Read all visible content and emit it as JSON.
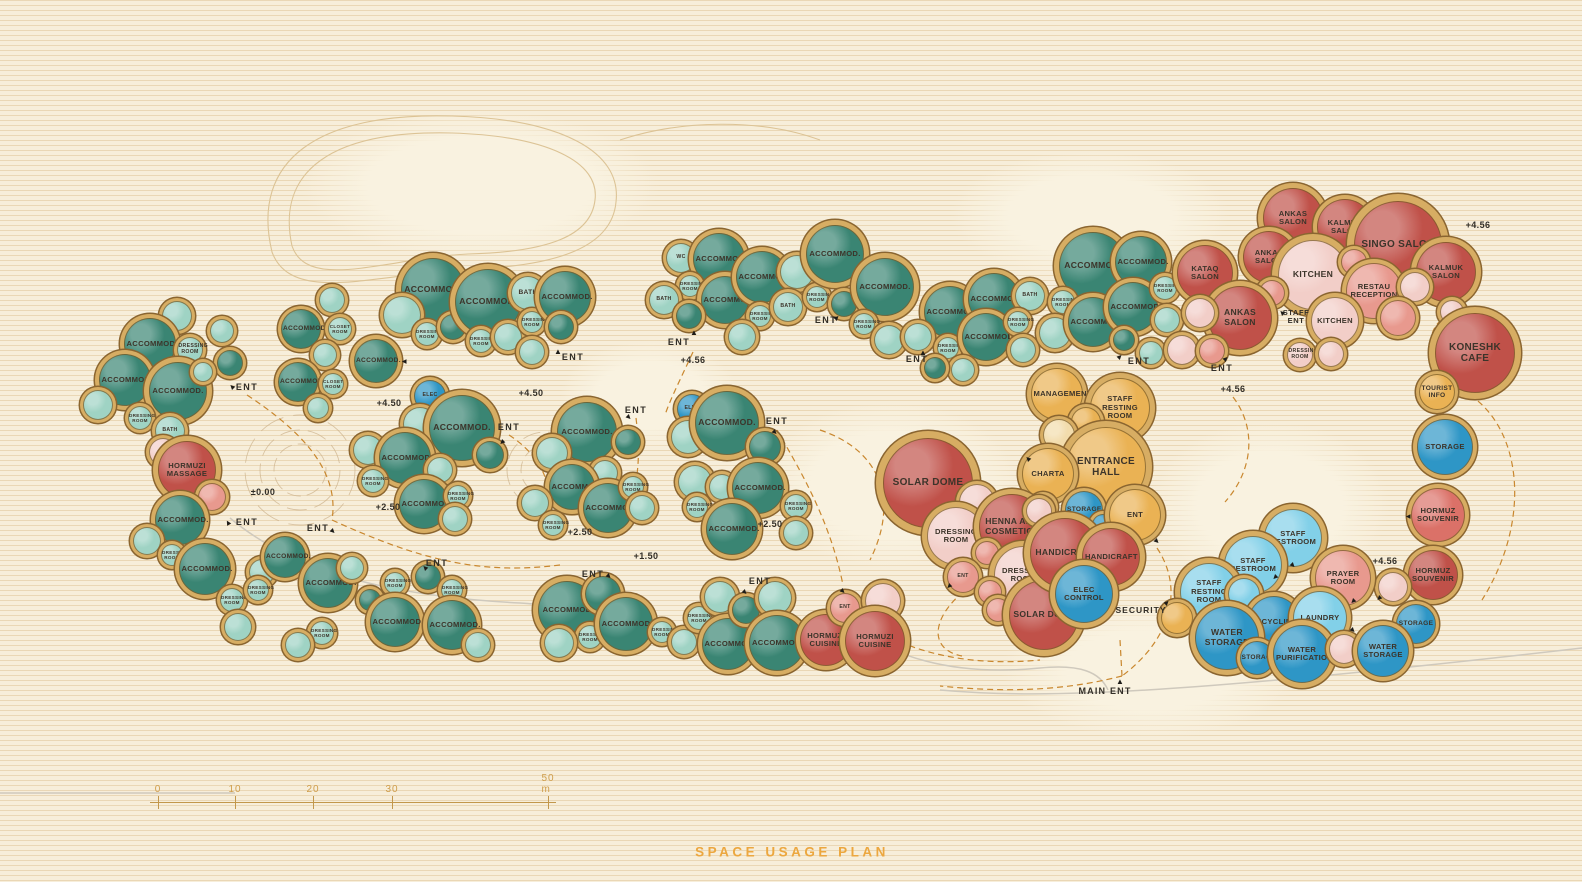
{
  "title": {
    "text": "SPACE USAGE PLAN"
  },
  "scale_bar": {
    "labels": [
      "0",
      "10",
      "20",
      "30",
      "50 m"
    ],
    "positions": [
      158,
      235,
      313,
      392,
      548
    ],
    "line": {
      "x1": 150,
      "x2": 556,
      "y": 802
    },
    "tick_top": 796,
    "tick_height": 13,
    "label_y": 795
  },
  "colors": {
    "t": "#3A8573",
    "tl": "#9FD3C4",
    "r": "#C05149",
    "rs": "#DB7168",
    "pl": "#F2CEC8",
    "pm": "#E8998E",
    "y": "#EAB254",
    "yl": "#F2DCAC",
    "b": "#2E96C6",
    "bl": "#82D0E8",
    "ring": "#D7AD63",
    "ringEdge": "#8A6530",
    "path_dashed": "#C9872E",
    "road": "#CFC9BD",
    "contour": "#DCC395",
    "label": "#3C342A",
    "title": "#ECA73F",
    "scale": "#CF9D4A"
  },
  "domes_format": "[cx, cy, radius, colorKey, label?]",
  "domes": [
    [
      177,
      316,
      15,
      "tl"
    ],
    [
      222,
      331,
      12,
      "tl"
    ],
    [
      150,
      344,
      26,
      "t",
      "ACCOMMOD."
    ],
    [
      190,
      350,
      13,
      "tl",
      "DRESSING ROOM"
    ],
    [
      230,
      363,
      13,
      "t"
    ],
    [
      125,
      380,
      26,
      "t",
      "ACCOMMOD."
    ],
    [
      178,
      391,
      29,
      "t",
      "ACCOMMOD."
    ],
    [
      203,
      372,
      10,
      "tl"
    ],
    [
      98,
      405,
      15,
      "tl"
    ],
    [
      140,
      418,
      12,
      "tl",
      "DRESSING ROOM"
    ],
    [
      170,
      431,
      15,
      "tl",
      "BATH"
    ],
    [
      163,
      452,
      14,
      "pl"
    ],
    [
      187,
      470,
      29,
      "r",
      "HORMUZI MASSAGE"
    ],
    [
      212,
      497,
      14,
      "pm"
    ],
    [
      180,
      520,
      25,
      "t",
      "ACCOMMOD."
    ],
    [
      147,
      541,
      14,
      "tl"
    ],
    [
      172,
      555,
      11,
      "tl",
      "DRESSING ROOM"
    ],
    [
      205,
      569,
      26,
      "t",
      "ACCOMMOD."
    ],
    [
      232,
      600,
      12,
      "tl",
      "DRESSING ROOM"
    ],
    [
      262,
      572,
      13,
      "tl"
    ],
    [
      285,
      557,
      21,
      "t",
      "ACCOMMOD."
    ],
    [
      258,
      590,
      11,
      "tl",
      "DRESSING ROOM"
    ],
    [
      238,
      627,
      14,
      "tl"
    ],
    [
      328,
      583,
      25,
      "t",
      "ACCOMMOD."
    ],
    [
      352,
      568,
      12,
      "tl"
    ],
    [
      322,
      633,
      12,
      "tl",
      "DRESSING ROOM"
    ],
    [
      298,
      645,
      13,
      "tl"
    ],
    [
      370,
      600,
      11,
      "t"
    ],
    [
      395,
      583,
      11,
      "tl",
      "DRESSING ROOM"
    ],
    [
      395,
      622,
      25,
      "t",
      "ACCOMMOD."
    ],
    [
      428,
      577,
      13,
      "t"
    ],
    [
      452,
      590,
      11,
      "tl",
      "DRESSING ROOM"
    ],
    [
      452,
      625,
      25,
      "t",
      "ACCOMMOD."
    ],
    [
      478,
      645,
      13,
      "tl"
    ],
    [
      332,
      300,
      13,
      "tl"
    ],
    [
      301,
      329,
      20,
      "t",
      "ACCOMMOD."
    ],
    [
      340,
      329,
      12,
      "tl",
      "CLOSET ROOM"
    ],
    [
      325,
      355,
      12,
      "tl"
    ],
    [
      376,
      361,
      22,
      "t",
      "ACCOMMOD."
    ],
    [
      298,
      382,
      20,
      "t",
      "ACCOMMOD."
    ],
    [
      333,
      384,
      11,
      "tl",
      "CLOSET ROOM"
    ],
    [
      318,
      408,
      11,
      "tl"
    ],
    [
      430,
      396,
      16,
      "b",
      "ELEC"
    ],
    [
      420,
      424,
      17,
      "tl"
    ],
    [
      462,
      428,
      33,
      "t",
      "ACCOMMOD."
    ],
    [
      490,
      455,
      14,
      "t"
    ],
    [
      368,
      450,
      15,
      "tl"
    ],
    [
      405,
      458,
      26,
      "t",
      "ACCOMMOD."
    ],
    [
      373,
      481,
      12,
      "tl",
      "DRESSING ROOM"
    ],
    [
      440,
      470,
      13,
      "tl"
    ],
    [
      424,
      504,
      25,
      "t",
      "ACCOMMOD."
    ],
    [
      458,
      496,
      11,
      "tl",
      "DRESSING ROOM"
    ],
    [
      455,
      519,
      13,
      "tl"
    ],
    [
      433,
      290,
      32,
      "t",
      "ACCOMMOD."
    ],
    [
      402,
      315,
      19,
      "tl"
    ],
    [
      427,
      334,
      12,
      "tl",
      "DRESSING ROOM"
    ],
    [
      453,
      327,
      13,
      "t"
    ],
    [
      488,
      302,
      33,
      "t",
      "ACCOMMOD."
    ],
    [
      481,
      341,
      12,
      "tl",
      "DRESSING ROOM"
    ],
    [
      508,
      337,
      14,
      "tl"
    ],
    [
      528,
      293,
      17,
      "tl",
      "BATH"
    ],
    [
      532,
      322,
      11,
      "tl",
      "DRESSING ROOM"
    ],
    [
      565,
      297,
      26,
      "t",
      "ACCOMMOD."
    ],
    [
      561,
      327,
      13,
      "t"
    ],
    [
      532,
      352,
      13,
      "tl"
    ],
    [
      587,
      432,
      30,
      "t",
      "ACCOMMOD."
    ],
    [
      552,
      453,
      16,
      "tl"
    ],
    [
      628,
      442,
      13,
      "t"
    ],
    [
      605,
      473,
      13,
      "tl"
    ],
    [
      572,
      487,
      23,
      "t",
      "ACCOMMOD."
    ],
    [
      535,
      503,
      14,
      "tl"
    ],
    [
      553,
      525,
      11,
      "tl",
      "DRESSING ROOM"
    ],
    [
      608,
      508,
      25,
      "t",
      "ACCOMMOD."
    ],
    [
      633,
      487,
      11,
      "tl",
      "DRESSING ROOM"
    ],
    [
      642,
      508,
      13,
      "tl"
    ],
    [
      692,
      409,
      15,
      "b",
      "ELEC"
    ],
    [
      688,
      437,
      17,
      "tl"
    ],
    [
      727,
      423,
      32,
      "t",
      "ACCOMMOD."
    ],
    [
      765,
      447,
      16,
      "t"
    ],
    [
      695,
      482,
      17,
      "tl"
    ],
    [
      722,
      487,
      13,
      "tl"
    ],
    [
      697,
      507,
      11,
      "tl",
      "DRESSING ROOM"
    ],
    [
      758,
      488,
      26,
      "t",
      "ACCOMMOD."
    ],
    [
      796,
      506,
      12,
      "tl",
      "DRESSING ROOM"
    ],
    [
      732,
      529,
      26,
      "t",
      "ACCOMMOD."
    ],
    [
      796,
      533,
      13,
      "tl"
    ],
    [
      681,
      258,
      15,
      "tl",
      "WC"
    ],
    [
      719,
      259,
      26,
      "t",
      "ACCOMMOD."
    ],
    [
      690,
      286,
      11,
      "tl",
      "DRESSING ROOM"
    ],
    [
      664,
      300,
      15,
      "tl",
      "BATH"
    ],
    [
      725,
      300,
      24,
      "t",
      "ACCOMMOD."
    ],
    [
      689,
      316,
      13,
      "t"
    ],
    [
      762,
      277,
      26,
      "t",
      "ACCOMMOD."
    ],
    [
      760,
      316,
      11,
      "tl",
      "DRESSING ROOM"
    ],
    [
      742,
      337,
      14,
      "tl"
    ],
    [
      797,
      272,
      17,
      "tl"
    ],
    [
      788,
      307,
      15,
      "tl",
      "BATH"
    ],
    [
      817,
      297,
      11,
      "tl",
      "DRESSING ROOM"
    ],
    [
      835,
      254,
      29,
      "t",
      "ACCOMMOD."
    ],
    [
      844,
      304,
      13,
      "t"
    ],
    [
      885,
      287,
      29,
      "t",
      "ACCOMMOD."
    ],
    [
      864,
      324,
      11,
      "tl",
      "DRESSING ROOM"
    ],
    [
      889,
      340,
      15,
      "tl"
    ],
    [
      950,
      312,
      26,
      "t",
      "ACCOMMOD."
    ],
    [
      918,
      337,
      14,
      "tl"
    ],
    [
      948,
      348,
      11,
      "tl",
      "DRESSING ROOM"
    ],
    [
      994,
      299,
      26,
      "t",
      "ACCOMMOD."
    ],
    [
      986,
      337,
      24,
      "t",
      "ACCOMMOD."
    ],
    [
      1030,
      296,
      15,
      "tl",
      "BATH"
    ],
    [
      1018,
      322,
      11,
      "tl",
      "DRESSING ROOM"
    ],
    [
      1023,
      350,
      13,
      "tl"
    ],
    [
      963,
      370,
      12,
      "tl"
    ],
    [
      935,
      368,
      11,
      "t"
    ],
    [
      1093,
      266,
      34,
      "t",
      "ACCOMMOD."
    ],
    [
      1063,
      302,
      12,
      "tl",
      "DRESSING ROOM"
    ],
    [
      1055,
      333,
      16,
      "tl"
    ],
    [
      1093,
      322,
      25,
      "t",
      "ACCOMMOD."
    ],
    [
      1141,
      262,
      26,
      "t",
      "ACCOMMOD."
    ],
    [
      1133,
      307,
      25,
      "t",
      "ACCOMMOD."
    ],
    [
      1165,
      288,
      12,
      "tl",
      "DRESSING ROOM"
    ],
    [
      1167,
      320,
      13,
      "tl"
    ],
    [
      1151,
      353,
      12,
      "tl"
    ],
    [
      1124,
      340,
      11,
      "t"
    ],
    [
      1293,
      218,
      30,
      "r",
      "ANKAS SALON"
    ],
    [
      1345,
      227,
      28,
      "r",
      "KALMUK SALON"
    ],
    [
      1398,
      245,
      44,
      "r",
      "SINGO SALON"
    ],
    [
      1269,
      257,
      26,
      "r",
      "ANKAS SALON"
    ],
    [
      1205,
      273,
      28,
      "r",
      "KATAQ SALON"
    ],
    [
      1313,
      275,
      35,
      "pl",
      "KITCHEN"
    ],
    [
      1354,
      262,
      13,
      "pm"
    ],
    [
      1374,
      291,
      28,
      "pm",
      "RESTAU RECEPTION"
    ],
    [
      1446,
      272,
      30,
      "r",
      "KALMUK SALON"
    ],
    [
      1415,
      287,
      15,
      "pl"
    ],
    [
      1272,
      293,
      13,
      "pm"
    ],
    [
      1240,
      318,
      32,
      "r",
      "ANKAS SALON"
    ],
    [
      1200,
      313,
      15,
      "pl"
    ],
    [
      1182,
      350,
      15,
      "pl"
    ],
    [
      1212,
      351,
      13,
      "pm"
    ],
    [
      1335,
      321,
      24,
      "pl",
      "KITCHEN"
    ],
    [
      1398,
      318,
      18,
      "pm"
    ],
    [
      1300,
      355,
      13,
      "pl",
      "DRESSING ROOM"
    ],
    [
      1331,
      354,
      13,
      "pl"
    ],
    [
      1452,
      312,
      12,
      "pl"
    ],
    [
      1475,
      353,
      40,
      "r",
      "KONESHK CAFE"
    ],
    [
      1437,
      392,
      18,
      "y",
      "TOURIST INFO"
    ],
    [
      1445,
      447,
      28,
      "b",
      "STORAGE"
    ],
    [
      1438,
      515,
      27,
      "rs",
      "HORMUZ SOUVENIR"
    ],
    [
      1433,
      575,
      25,
      "r",
      "HORMUZ SOUVENIR"
    ],
    [
      1393,
      587,
      15,
      "pl"
    ],
    [
      1416,
      624,
      20,
      "b",
      "STORAGE"
    ],
    [
      1057,
      394,
      26,
      "y",
      "MANAGEMENT"
    ],
    [
      1120,
      408,
      30,
      "y",
      "STAFF RESTING ROOM"
    ],
    [
      1086,
      422,
      15,
      "y"
    ],
    [
      1059,
      435,
      16,
      "yl"
    ],
    [
      1106,
      467,
      40,
      "y",
      "ENTRANCE HALL"
    ],
    [
      1048,
      474,
      26,
      "y",
      "CHARTA"
    ],
    [
      1084,
      510,
      19,
      "b",
      "STORAGE"
    ],
    [
      1103,
      525,
      11,
      "b"
    ],
    [
      1135,
      515,
      26,
      "y",
      "ENT"
    ],
    [
      1043,
      507,
      12,
      "pl"
    ],
    [
      928,
      483,
      45,
      "r",
      "SOLAR DOME"
    ],
    [
      977,
      502,
      18,
      "pl"
    ],
    [
      956,
      536,
      29,
      "pl",
      "DRESSING ROOM"
    ],
    [
      1012,
      527,
      33,
      "r",
      "HENNA AND COSMETICS"
    ],
    [
      1039,
      511,
      13,
      "pl"
    ],
    [
      987,
      553,
      12,
      "pm"
    ],
    [
      963,
      577,
      16,
      "pm",
      "ENT"
    ],
    [
      1023,
      575,
      29,
      "pl",
      "DRESSING ROOM"
    ],
    [
      990,
      592,
      12,
      "pm"
    ],
    [
      998,
      610,
      12,
      "pm"
    ],
    [
      1044,
      615,
      35,
      "r",
      "SOLAR DOME"
    ],
    [
      1065,
      553,
      35,
      "r",
      "HANDICRAFT"
    ],
    [
      1111,
      557,
      29,
      "r",
      "HANDICRAFT"
    ],
    [
      1084,
      594,
      29,
      "b",
      "ELEC CONTROL"
    ],
    [
      1293,
      538,
      29,
      "bl",
      "STAFF RESTROOM"
    ],
    [
      1253,
      565,
      29,
      "bl",
      "STAFF RESTROOM"
    ],
    [
      1209,
      592,
      29,
      "bl",
      "STAFF RESTING ROOM"
    ],
    [
      1244,
      594,
      16,
      "bl"
    ],
    [
      1177,
      618,
      16,
      "y"
    ],
    [
      1343,
      578,
      28,
      "pm",
      "PRAYER ROOM"
    ],
    [
      1274,
      622,
      26,
      "b",
      "RECYCLING"
    ],
    [
      1320,
      618,
      27,
      "bl",
      "LAUNDRY"
    ],
    [
      1227,
      638,
      32,
      "b",
      "WATER STORAGE"
    ],
    [
      1257,
      658,
      17,
      "b",
      "STORAGE"
    ],
    [
      1302,
      654,
      29,
      "b",
      "WATER PURIFICATION"
    ],
    [
      1344,
      649,
      15,
      "pl"
    ],
    [
      1383,
      651,
      26,
      "b",
      "WATER STORAGE"
    ],
    [
      567,
      610,
      29,
      "t",
      "ACCOMMOD"
    ],
    [
      603,
      594,
      18,
      "t"
    ],
    [
      590,
      637,
      12,
      "tl",
      "DRESSING ROOM"
    ],
    [
      559,
      643,
      15,
      "tl"
    ],
    [
      626,
      624,
      27,
      "t",
      "ACCOMMOD"
    ],
    [
      662,
      632,
      11,
      "tl",
      "DRESSING ROOM"
    ],
    [
      684,
      642,
      13,
      "tl"
    ],
    [
      699,
      618,
      12,
      "tl",
      "DRESSING ROOM"
    ],
    [
      720,
      597,
      16,
      "tl"
    ],
    [
      728,
      644,
      26,
      "t",
      "ACCOMMOD"
    ],
    [
      746,
      610,
      14,
      "t"
    ],
    [
      775,
      598,
      17,
      "tl"
    ],
    [
      777,
      643,
      28,
      "t",
      "ACCOMMOD."
    ],
    [
      826,
      640,
      26,
      "r",
      "HORMUZI CUISINE"
    ],
    [
      845,
      608,
      15,
      "pm",
      "ENT"
    ],
    [
      883,
      601,
      18,
      "pl"
    ],
    [
      875,
      641,
      30,
      "r",
      "HORMUZI CUISINE"
    ]
  ],
  "annotations": [
    {
      "x": 247,
      "y": 387,
      "text": "ENT",
      "kind": "ent"
    },
    {
      "x": 247,
      "y": 522,
      "text": "ENT",
      "kind": "ent"
    },
    {
      "x": 318,
      "y": 528,
      "text": "ENT",
      "kind": "ent"
    },
    {
      "x": 437,
      "y": 563,
      "text": "ENT",
      "kind": "ent"
    },
    {
      "x": 509,
      "y": 427,
      "text": "ENT",
      "kind": "ent"
    },
    {
      "x": 636,
      "y": 410,
      "text": "ENT",
      "kind": "ent"
    },
    {
      "x": 679,
      "y": 342,
      "text": "ENT",
      "kind": "ent"
    },
    {
      "x": 573,
      "y": 357,
      "text": "ENT",
      "kind": "ent"
    },
    {
      "x": 826,
      "y": 320,
      "text": "ENT",
      "kind": "ent"
    },
    {
      "x": 917,
      "y": 359,
      "text": "ENT",
      "kind": "ent"
    },
    {
      "x": 1139,
      "y": 361,
      "text": "ENT",
      "kind": "ent"
    },
    {
      "x": 777,
      "y": 421,
      "text": "ENT",
      "kind": "ent"
    },
    {
      "x": 593,
      "y": 574,
      "text": "ENT",
      "kind": "ent"
    },
    {
      "x": 760,
      "y": 581,
      "text": "ENT",
      "kind": "ent"
    },
    {
      "x": 1222,
      "y": 368,
      "text": "ENT",
      "kind": "ent"
    },
    {
      "x": 1296,
      "y": 317,
      "text": "STAFF\nENT",
      "kind": "ent2"
    },
    {
      "x": 1105,
      "y": 691,
      "text": "MAIN ENT",
      "kind": "main"
    },
    {
      "x": 1141,
      "y": 610,
      "text": "SECURITY",
      "kind": "sec"
    },
    {
      "x": 263,
      "y": 492,
      "text": "±0.00",
      "kind": "elev"
    },
    {
      "x": 389,
      "y": 403,
      "text": "+4.50",
      "kind": "elev"
    },
    {
      "x": 531,
      "y": 393,
      "text": "+4.50",
      "kind": "elev"
    },
    {
      "x": 388,
      "y": 507,
      "text": "+2.50",
      "kind": "elev"
    },
    {
      "x": 580,
      "y": 532,
      "text": "+2.50",
      "kind": "elev"
    },
    {
      "x": 770,
      "y": 524,
      "text": "+2.50",
      "kind": "elev"
    },
    {
      "x": 646,
      "y": 556,
      "text": "+1.50",
      "kind": "elev"
    },
    {
      "x": 693,
      "y": 360,
      "text": "+4.56",
      "kind": "elev"
    },
    {
      "x": 1233,
      "y": 389,
      "text": "+4.56",
      "kind": "elev"
    },
    {
      "x": 1478,
      "y": 225,
      "text": "+4.56",
      "kind": "elev"
    },
    {
      "x": 1385,
      "y": 561,
      "text": "+4.56",
      "kind": "elev"
    }
  ],
  "arrows": [
    [
      232,
      387,
      -45
    ],
    [
      228,
      523,
      -30
    ],
    [
      333,
      532,
      135
    ],
    [
      425,
      568,
      -45
    ],
    [
      502,
      443,
      -135
    ],
    [
      629,
      418,
      135
    ],
    [
      694,
      333,
      0
    ],
    [
      558,
      352,
      0
    ],
    [
      837,
      318,
      45
    ],
    [
      923,
      353,
      0
    ],
    [
      1120,
      357,
      45
    ],
    [
      775,
      433,
      135
    ],
    [
      609,
      577,
      135
    ],
    [
      745,
      593,
      135
    ],
    [
      843,
      592,
      135
    ],
    [
      1226,
      359,
      45
    ],
    [
      1282,
      313,
      -45
    ],
    [
      949,
      587,
      -135
    ],
    [
      1167,
      603,
      45
    ],
    [
      1028,
      459,
      -45
    ],
    [
      1157,
      542,
      135
    ],
    [
      1275,
      578,
      -135
    ],
    [
      1293,
      566,
      135
    ],
    [
      1353,
      602,
      -135
    ],
    [
      1379,
      599,
      -135
    ],
    [
      1353,
      631,
      135
    ],
    [
      1120,
      682,
      0
    ],
    [
      404,
      362,
      -90
    ],
    [
      1408,
      517,
      -90
    ]
  ]
}
